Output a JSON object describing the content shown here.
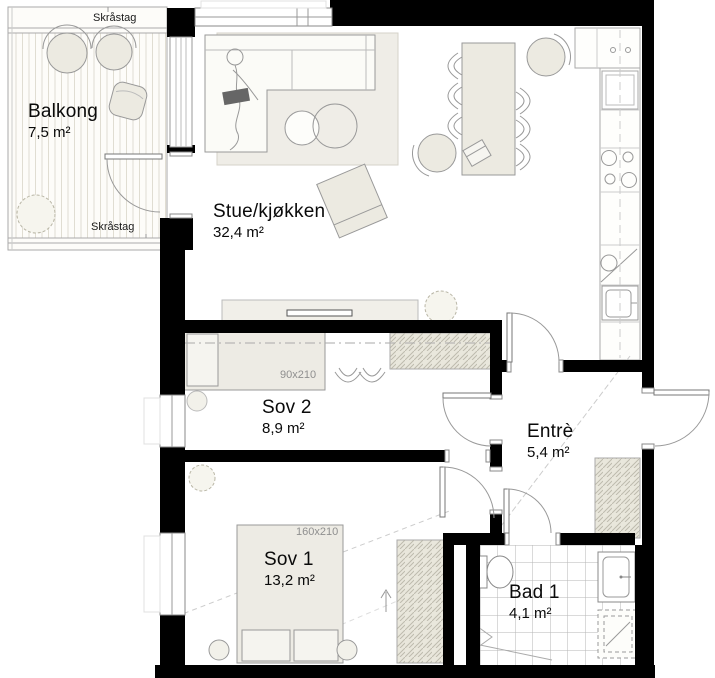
{
  "plan": {
    "rooms": [
      {
        "id": "balkong",
        "name": "Balkong",
        "area": "7,5 m²"
      },
      {
        "id": "stue",
        "name": "Stue/kjøkken",
        "area": "32,4 m²"
      },
      {
        "id": "sov2",
        "name": "Sov 2",
        "area": "8,9 m²"
      },
      {
        "id": "entre",
        "name": "Entrè",
        "area": "5,4 m²"
      },
      {
        "id": "sov1",
        "name": "Sov 1",
        "area": "13,2 m²"
      },
      {
        "id": "bad1",
        "name": "Bad 1",
        "area": "4,1 m²"
      }
    ],
    "annotations": {
      "skrastag_top": "Skråstag",
      "skrastag_bottom": "Skråstag",
      "bed_sov2_dim": "90x210",
      "bed_sov1_dim": "160x210"
    },
    "colors": {
      "wall": "#000000",
      "furniture_fill": "#eceae1",
      "bed_fill": "#edebe4",
      "rug_fill": "#efede7",
      "outline": "#999999",
      "dim_text": "#8f8f8f",
      "tile_line": "#b5b5b5"
    }
  }
}
